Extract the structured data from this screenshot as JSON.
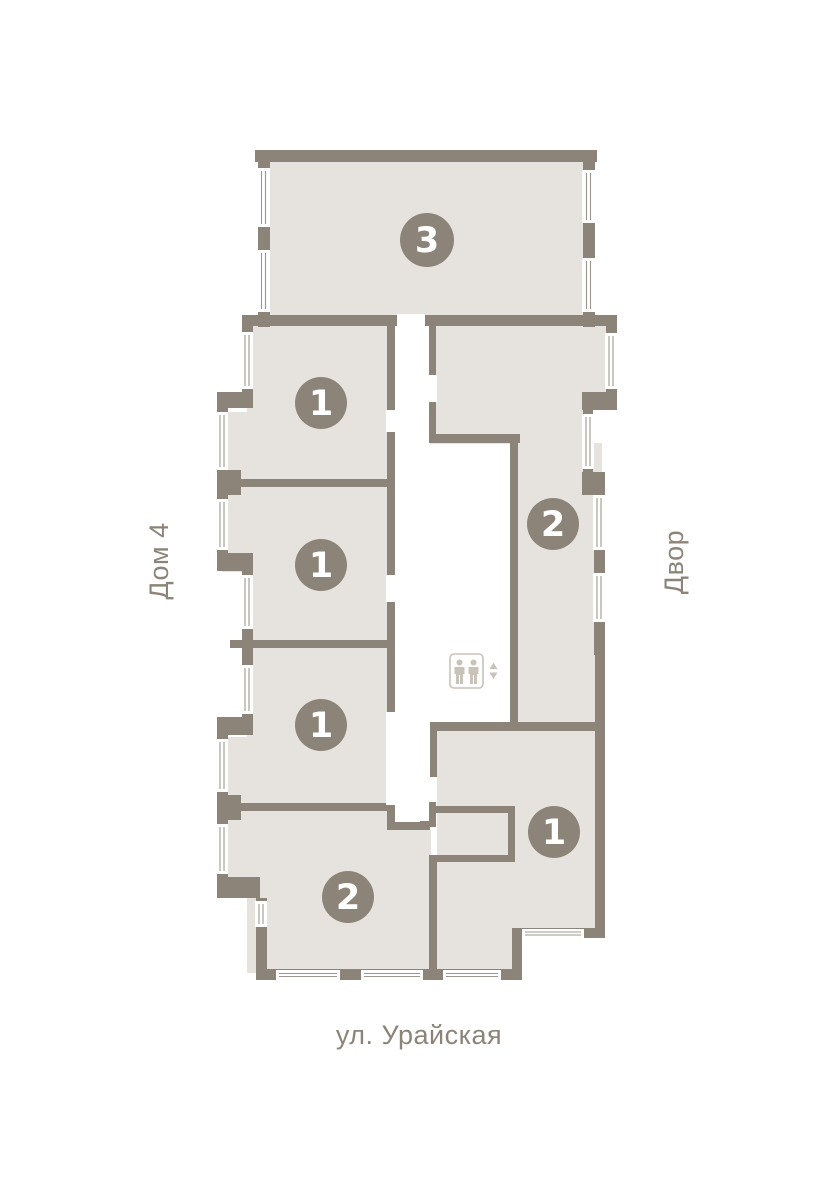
{
  "plan": {
    "street_label": "ул. Урайская",
    "left_side_label": "Дом 4",
    "right_side_label": "Двор",
    "elevator_icon": "elevator-two-people-up-down-icon",
    "units": [
      {
        "id": "top",
        "rooms": "3"
      },
      {
        "id": "upper-left",
        "rooms": "1"
      },
      {
        "id": "right",
        "rooms": "2"
      },
      {
        "id": "middle-left",
        "rooms": "1"
      },
      {
        "id": "lower-left",
        "rooms": "1"
      },
      {
        "id": "bottom-right",
        "rooms": "1"
      },
      {
        "id": "bottom-left",
        "rooms": "2"
      }
    ],
    "colors": {
      "wall": "#8C8478",
      "floor": "#E6E3DE",
      "window_line": "#8C8478",
      "icon": "#C9C2B9",
      "label_text": "#8C8478",
      "number_text": "#FFFFFF",
      "background": "#FFFFFF"
    }
  }
}
